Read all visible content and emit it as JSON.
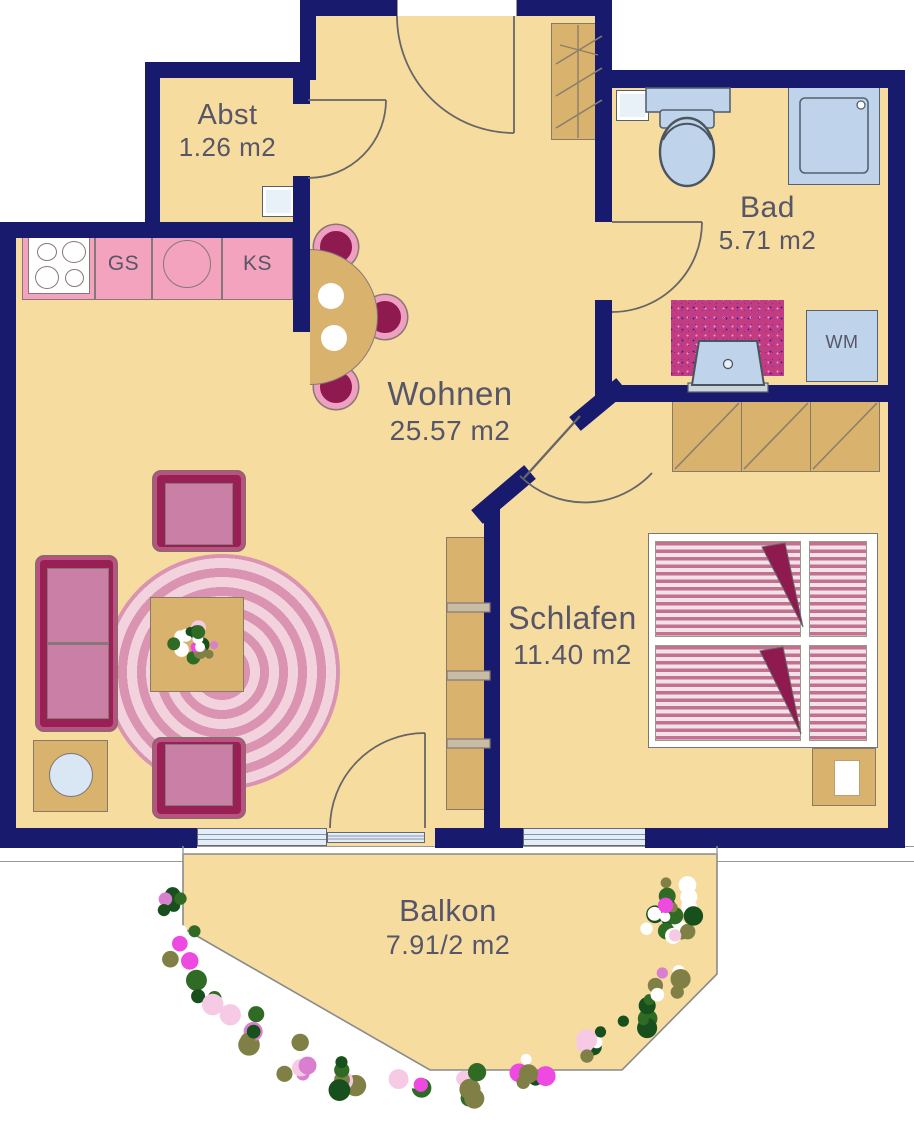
{
  "plan": {
    "rooms": [
      {
        "id": "abst",
        "label": "Abst",
        "area": "1.26 m2"
      },
      {
        "id": "bad",
        "label": "Bad",
        "area": "5.71 m2"
      },
      {
        "id": "wohnen",
        "label": "Wohnen",
        "area": "25.57 m2"
      },
      {
        "id": "schlafen",
        "label": "Schlafen",
        "area": "11.40 m2"
      },
      {
        "id": "balkon",
        "label": "Balkon",
        "area": "7.91/2 m2"
      }
    ],
    "kitchen": {
      "dishwasher_label": "GS",
      "fridge_label": "KS"
    },
    "bath": {
      "washing_machine_label": "WM"
    },
    "colors": {
      "wall": "#171A6D",
      "floor": "#F7DCA0",
      "counter_pink": "#F3A3BD",
      "furniture_maroon": "#8E1A50",
      "cushion": "#C97FA6",
      "wood": "#D9B26E",
      "fixture_blue": "#BFD4EA",
      "label_ink": "#565668"
    },
    "decor": {
      "flower_palette": [
        "#17501d",
        "#2f6b24",
        "#808046",
        "#ffffff",
        "#f6c9e4",
        "#ee49e0",
        "#d87fd0"
      ],
      "garland_path": [
        [
          172,
          898
        ],
        [
          184,
          946
        ],
        [
          208,
          992
        ],
        [
          246,
          1030
        ],
        [
          296,
          1058
        ],
        [
          352,
          1078
        ],
        [
          412,
          1087
        ],
        [
          472,
          1083
        ],
        [
          532,
          1067
        ],
        [
          586,
          1043
        ],
        [
          634,
          1013
        ],
        [
          668,
          986
        ]
      ],
      "pot_center": [
        672,
        916
      ],
      "pot_radius": 40,
      "bouquet_center": [
        197,
        645
      ],
      "bouquet_radius": 24
    }
  }
}
